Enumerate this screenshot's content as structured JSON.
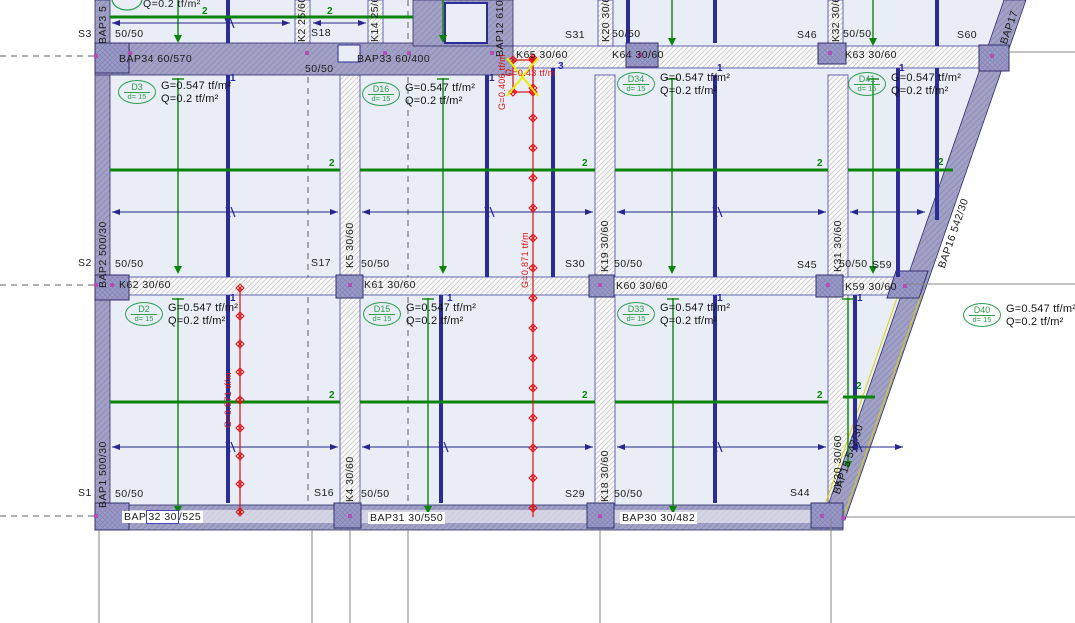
{
  "colors": {
    "slab": "#e8edf6",
    "band_purple": "#a1a1c5",
    "band_hatch": "#8e8eb8",
    "column": "#9a9ac8",
    "navy": "#2c2c96",
    "green": "#0a840a",
    "tag_green": "#2f9e4f",
    "dim_blue": "#26268c",
    "red": "#e01010",
    "yellow": "#ecec00",
    "dash_gray": "#606060",
    "grid_gray": "#858585",
    "node_magenta": "#b44fb4"
  },
  "slab_default": {
    "g": "G=0.547 tf/m²",
    "q": "Q=0.2 tf/m²",
    "d": "d= 15"
  },
  "slab_tags": [
    {
      "id": "D3",
      "x": 118,
      "y": 80
    },
    {
      "id": "D16",
      "x": 362,
      "y": 82
    },
    {
      "id": "D34",
      "x": 617,
      "y": 72
    },
    {
      "id": "D41",
      "x": 848,
      "y": 72
    },
    {
      "id": "D2",
      "x": 125,
      "y": 302
    },
    {
      "id": "D15",
      "x": 363,
      "y": 302
    },
    {
      "id": "D33",
      "x": 617,
      "y": 302
    },
    {
      "id": "D40",
      "x": 963,
      "y": 303
    }
  ],
  "labels": [
    {
      "t": "S3",
      "x": 78,
      "y": 28,
      "n": "grid-label"
    },
    {
      "t": "50/50",
      "x": 115,
      "y": 28,
      "n": "column-size-label"
    },
    {
      "t": "S18",
      "x": 311,
      "y": 27,
      "n": "grid-label"
    },
    {
      "t": "50/50",
      "x": 305,
      "y": 63,
      "n": "column-size-label"
    },
    {
      "t": "S31",
      "x": 565,
      "y": 29,
      "n": "grid-label"
    },
    {
      "t": "50/50",
      "x": 612,
      "y": 28,
      "n": "column-size-label"
    },
    {
      "t": "S46",
      "x": 797,
      "y": 29,
      "n": "grid-label"
    },
    {
      "t": "50/50",
      "x": 843,
      "y": 28,
      "n": "column-size-label"
    },
    {
      "t": "S60",
      "x": 957,
      "y": 29,
      "n": "grid-label"
    },
    {
      "t": "BAP34 60/570",
      "x": 119,
      "y": 53,
      "n": "beam-label"
    },
    {
      "t": "BAP33 60/400",
      "x": 357,
      "y": 53,
      "n": "beam-label"
    },
    {
      "t": "K65 30/60",
      "x": 516,
      "y": 49,
      "n": "beam-label"
    },
    {
      "t": "K64 30/60",
      "x": 612,
      "y": 49,
      "n": "beam-label"
    },
    {
      "t": "K63 30/60",
      "x": 845,
      "y": 49,
      "n": "beam-label"
    },
    {
      "t": "S2",
      "x": 78,
      "y": 257,
      "n": "grid-label"
    },
    {
      "t": "50/50",
      "x": 115,
      "y": 258,
      "n": "column-size-label"
    },
    {
      "t": "S17",
      "x": 311,
      "y": 257,
      "n": "grid-label"
    },
    {
      "t": "50/50",
      "x": 361,
      "y": 258,
      "n": "column-size-label"
    },
    {
      "t": "S30",
      "x": 565,
      "y": 258,
      "n": "grid-label"
    },
    {
      "t": "50/50",
      "x": 614,
      "y": 258,
      "n": "column-size-label"
    },
    {
      "t": "S45",
      "x": 797,
      "y": 259,
      "n": "grid-label"
    },
    {
      "t": "50/50",
      "x": 839,
      "y": 258,
      "n": "column-size-label"
    },
    {
      "t": "S59",
      "x": 872,
      "y": 259,
      "n": "grid-label"
    },
    {
      "t": "K62 30/60",
      "x": 119,
      "y": 279,
      "n": "beam-label"
    },
    {
      "t": "K61 30/60",
      "x": 364,
      "y": 279,
      "n": "beam-label"
    },
    {
      "t": "K60 30/60",
      "x": 616,
      "y": 280,
      "n": "beam-label"
    },
    {
      "t": "K59 30/60",
      "x": 845,
      "y": 281,
      "n": "beam-label"
    },
    {
      "t": "S1",
      "x": 78,
      "y": 487,
      "n": "grid-label"
    },
    {
      "t": "50/50",
      "x": 115,
      "y": 488,
      "n": "column-size-label"
    },
    {
      "t": "S16",
      "x": 314,
      "y": 487,
      "n": "grid-label"
    },
    {
      "t": "50/50",
      "x": 361,
      "y": 488,
      "n": "column-size-label"
    },
    {
      "t": "S29",
      "x": 565,
      "y": 488,
      "n": "grid-label"
    },
    {
      "t": "50/50",
      "x": 614,
      "y": 488,
      "n": "column-size-label"
    },
    {
      "t": "S44",
      "x": 790,
      "y": 487,
      "n": "grid-label"
    },
    {
      "t": "BAP31 30/550",
      "x": 368,
      "y": 512,
      "n": "beam-label",
      "c": "wbg"
    },
    {
      "t": "BAP30 30/482",
      "x": 620,
      "y": 512,
      "n": "beam-label",
      "c": "wbg"
    }
  ],
  "rot_labels": [
    {
      "t": "BAP3 5",
      "x": 97,
      "y": 44,
      "r": -90
    },
    {
      "t": "BAP2 500/30",
      "x": 97,
      "y": 288,
      "r": -90
    },
    {
      "t": "BAP1 500/30",
      "x": 97,
      "y": 508,
      "r": -90
    },
    {
      "t": "K5 30/60",
      "x": 344,
      "y": 268,
      "r": -90
    },
    {
      "t": "K4 30/60",
      "x": 344,
      "y": 502,
      "r": -90
    },
    {
      "t": "K19 30/60",
      "x": 599,
      "y": 272,
      "r": -90
    },
    {
      "t": "K18 30/60",
      "x": 599,
      "y": 502,
      "r": -90
    },
    {
      "t": "K31 30/60",
      "x": 832,
      "y": 272,
      "r": -90
    },
    {
      "t": "K30 30/60",
      "x": 832,
      "y": 487,
      "r": -90
    },
    {
      "t": "K32 30/60",
      "x": 830,
      "y": 42,
      "r": -90
    },
    {
      "t": "K20 30/60",
      "x": 600,
      "y": 42,
      "r": -90
    },
    {
      "t": "K2 25/60",
      "x": 296,
      "y": 42,
      "r": -90
    },
    {
      "t": "K14 25/60",
      "x": 369,
      "y": 42,
      "r": -90
    },
    {
      "t": "BAP12 610/",
      "x": 494,
      "y": 57,
      "r": -90
    },
    {
      "t": "BAP17",
      "x": 998,
      "y": 42,
      "r": -71
    },
    {
      "t": "BAP16 542/30",
      "x": 936,
      "y": 266,
      "r": -71
    },
    {
      "t": "BAP15 542/30",
      "x": 831,
      "y": 492,
      "r": -71
    }
  ],
  "marks": {
    "ones": [
      {
        "x": 230,
        "y": 74
      },
      {
        "x": 489,
        "y": 74
      },
      {
        "x": 717,
        "y": 64
      },
      {
        "x": 899,
        "y": 64
      },
      {
        "x": 230,
        "y": 294
      },
      {
        "x": 447,
        "y": 294
      },
      {
        "x": 717,
        "y": 294
      },
      {
        "x": 857,
        "y": 294
      }
    ],
    "twos": [
      {
        "x": 202,
        "y": 7
      },
      {
        "x": 327,
        "y": 7
      },
      {
        "x": 329,
        "y": 159
      },
      {
        "x": 582,
        "y": 159
      },
      {
        "x": 817,
        "y": 159
      },
      {
        "x": 938,
        "y": 158
      },
      {
        "x": 329,
        "y": 391
      },
      {
        "x": 582,
        "y": 391
      },
      {
        "x": 817,
        "y": 391
      },
      {
        "x": 856,
        "y": 382
      }
    ],
    "threes": [
      {
        "x": 558,
        "y": 62
      }
    ]
  },
  "red_texts": [
    {
      "t": "G=0.406 tf/m",
      "x": 498,
      "y": 110,
      "r": -90
    },
    {
      "t": "G=0.43 tf/m",
      "x": 505,
      "y": 69,
      "r": 0
    },
    {
      "t": "G=0.871 tf/m",
      "x": 521,
      "y": 288,
      "r": -90
    },
    {
      "t": "G=0.871 tf/m",
      "x": 224,
      "y": 428,
      "r": -90
    }
  ],
  "load_lines": [
    {
      "x": 533,
      "y1": 58,
      "y2": 517,
      "spacing": 30
    },
    {
      "x": 240,
      "y1": 288,
      "y2": 515,
      "spacing": 28
    }
  ],
  "load_box": {
    "x": 513,
    "y": 60,
    "w": 20,
    "h": 32
  },
  "partial_tag": {
    "t": "Q=0.2 tf/m²",
    "x": 143,
    "y": -2
  },
  "bap32": {
    "pre": "BAP",
    "boxed": "32 30",
    "post": "/525",
    "x": 122,
    "y": 511
  }
}
